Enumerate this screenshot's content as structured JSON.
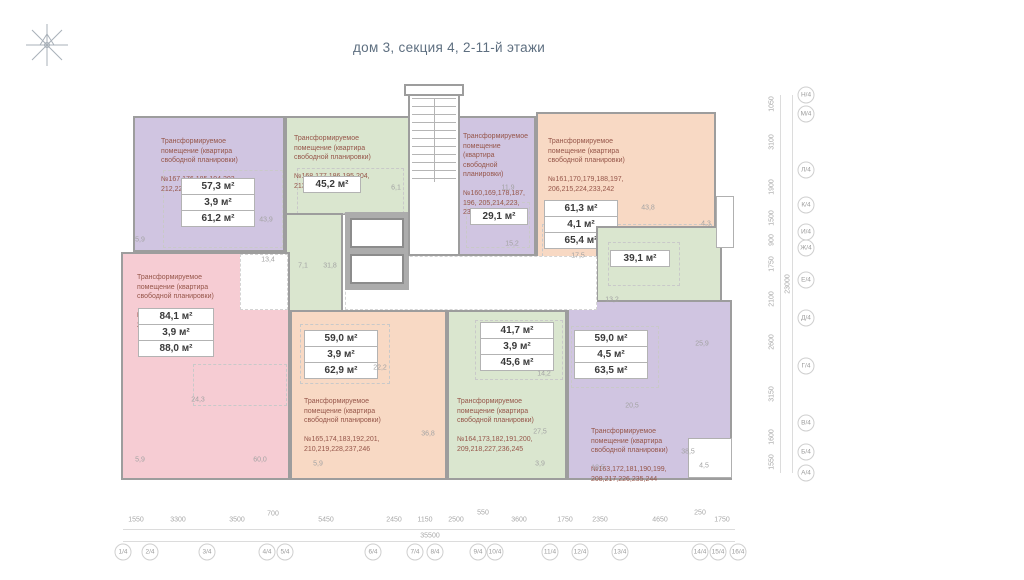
{
  "title": "дом 3, секция 4,  2-11-й этажи",
  "colors": {
    "purple": "#d0c5e1",
    "green": "#dae6cf",
    "orange": "#f8d9c4",
    "pink": "#f6ccd3",
    "wall": "#9d9d9d",
    "label_text": "#96564a",
    "dim_text": "#a3a3a3",
    "title_text": "#5e6f80"
  },
  "apartments": [
    {
      "label": "Трансформируемое\nпомещение (квартира\nсвободной планировки)",
      "numbers": "№167,176,185,194,203,\n212,221,230,239,248",
      "areas": [
        "57,3 м²",
        "3,9 м²",
        "61,2 м²"
      ]
    },
    {
      "label": "Трансформируемое\nпомещение (квартира\nсвободной планировки)",
      "numbers": "№168,177,186,195,204,\n213,222,231,240,249",
      "areas": [
        "45,2 м²"
      ]
    },
    {
      "label": "Трансформируемое\nпомещение\n(квартира\nсвободной\nпланировки)",
      "numbers": "№160,169,178,187,\n196, 205,214,223,\n232,241",
      "areas": [
        "29,1 м²"
      ]
    },
    {
      "label": "Трансформируемое\nпомещение (квартира\nсвободной планировки)",
      "numbers": "№161,170,179,188,197,\n206,215,224,233,242",
      "areas": [
        "61,3 м²",
        "4,1 м²",
        "65,4 м²"
      ]
    },
    {
      "label": "Трансформируемое\nпомещение (квартира\nсвободной планировки)",
      "numbers": "№162,171,180,189,198,\n207,216,225,234,243",
      "areas": [
        "39,1 м²"
      ]
    },
    {
      "label": "Трансформируемое\nпомещение (квартира\nсвободной планировки)",
      "numbers": "№166,175,184,193,202,\n211,220,229,238,247",
      "areas": [
        "84,1 м²",
        "3,9 м²",
        "88,0 м²"
      ]
    },
    {
      "label": "Трансформируемое\nпомещение (квартира\nсвободной планировки)",
      "numbers": "№165,174,183,192,201,\n210,219,228,237,246",
      "areas": [
        "59,0 м²",
        "3,9 м²",
        "62,9 м²"
      ]
    },
    {
      "label": "Трансформируемое\nпомещение (квартира\nсвободной планировки)",
      "numbers": "№164,173,182,191,200,\n209,218,227,236,245",
      "areas": [
        "41,7 м²",
        "3,9 м²",
        "45,6 м²"
      ]
    },
    {
      "label": "Трансформируемое\nпомещение (квартира\nсвободной планировки)",
      "numbers": "№163,172,181,190,199,\n208,217,226,235,244",
      "areas": [
        "59,0 м²",
        "4,5 м²",
        "63,5 м²"
      ]
    }
  ],
  "interior_dims": [
    {
      "t": "5,9",
      "x": 140,
      "y": 240
    },
    {
      "t": "43,9",
      "x": 266,
      "y": 220
    },
    {
      "t": "13,4",
      "x": 268,
      "y": 260
    },
    {
      "t": "7,1",
      "x": 303,
      "y": 266
    },
    {
      "t": "31,8",
      "x": 330,
      "y": 266
    },
    {
      "t": "6,1",
      "x": 396,
      "y": 188
    },
    {
      "t": "11,9",
      "x": 508,
      "y": 188
    },
    {
      "t": "15,2",
      "x": 512,
      "y": 244
    },
    {
      "t": "17,5",
      "x": 578,
      "y": 256
    },
    {
      "t": "43,8",
      "x": 648,
      "y": 208
    },
    {
      "t": "4,3",
      "x": 706,
      "y": 224
    },
    {
      "t": "13,2",
      "x": 612,
      "y": 300
    },
    {
      "t": "25,9",
      "x": 702,
      "y": 344
    },
    {
      "t": "24,3",
      "x": 198,
      "y": 400
    },
    {
      "t": "5,9",
      "x": 140,
      "y": 460
    },
    {
      "t": "60,0",
      "x": 260,
      "y": 460
    },
    {
      "t": "5,9",
      "x": 318,
      "y": 464
    },
    {
      "t": "22,2",
      "x": 380,
      "y": 368
    },
    {
      "t": "36,8",
      "x": 428,
      "y": 434
    },
    {
      "t": "14,2",
      "x": 544,
      "y": 374
    },
    {
      "t": "27,5",
      "x": 540,
      "y": 432
    },
    {
      "t": "3,9",
      "x": 540,
      "y": 464
    },
    {
      "t": "20,5",
      "x": 632,
      "y": 406
    },
    {
      "t": "38,5",
      "x": 688,
      "y": 452
    },
    {
      "t": "18,5",
      "x": 598,
      "y": 468
    },
    {
      "t": "4,5",
      "x": 704,
      "y": 466
    }
  ],
  "bottom_ruler": {
    "total": "35500",
    "segments": [
      {
        "t": "1550",
        "x": 136,
        "y": 520
      },
      {
        "t": "3300",
        "x": 178,
        "y": 520
      },
      {
        "t": "3500",
        "x": 237,
        "y": 520
      },
      {
        "t": "700",
        "x": 273,
        "y": 514
      },
      {
        "t": "5450",
        "x": 326,
        "y": 520
      },
      {
        "t": "2450",
        "x": 394,
        "y": 520
      },
      {
        "t": "1150",
        "x": 425,
        "y": 520
      },
      {
        "t": "2500",
        "x": 456,
        "y": 520
      },
      {
        "t": "550",
        "x": 483,
        "y": 513
      },
      {
        "t": "3600",
        "x": 519,
        "y": 520
      },
      {
        "t": "1750",
        "x": 565,
        "y": 520
      },
      {
        "t": "2350",
        "x": 600,
        "y": 520
      },
      {
        "t": "4650",
        "x": 660,
        "y": 520
      },
      {
        "t": "250",
        "x": 700,
        "y": 513
      },
      {
        "t": "1750",
        "x": 722,
        "y": 520
      }
    ],
    "bubbles": [
      {
        "t": "1/4",
        "x": 123,
        "y": 552
      },
      {
        "t": "2/4",
        "x": 150,
        "y": 552
      },
      {
        "t": "3/4",
        "x": 207,
        "y": 552
      },
      {
        "t": "4/4",
        "x": 267,
        "y": 552
      },
      {
        "t": "5/4",
        "x": 285,
        "y": 552
      },
      {
        "t": "6/4",
        "x": 373,
        "y": 552
      },
      {
        "t": "7/4",
        "x": 415,
        "y": 552
      },
      {
        "t": "8/4",
        "x": 435,
        "y": 552
      },
      {
        "t": "9/4",
        "x": 478,
        "y": 552
      },
      {
        "t": "10/4",
        "x": 495,
        "y": 552
      },
      {
        "t": "11/4",
        "x": 550,
        "y": 552
      },
      {
        "t": "12/4",
        "x": 580,
        "y": 552
      },
      {
        "t": "13/4",
        "x": 620,
        "y": 552
      },
      {
        "t": "14/4",
        "x": 700,
        "y": 552
      },
      {
        "t": "15/4",
        "x": 718,
        "y": 552
      },
      {
        "t": "16/4",
        "x": 738,
        "y": 552
      }
    ]
  },
  "right_ruler": {
    "total": "23000",
    "segments": [
      {
        "t": "1050",
        "x": 772,
        "y": 104
      },
      {
        "t": "3100",
        "x": 772,
        "y": 142
      },
      {
        "t": "1900",
        "x": 772,
        "y": 187
      },
      {
        "t": "1500",
        "x": 772,
        "y": 218
      },
      {
        "t": "900",
        "x": 772,
        "y": 240
      },
      {
        "t": "1750",
        "x": 772,
        "y": 264
      },
      {
        "t": "2100",
        "x": 772,
        "y": 299
      },
      {
        "t": "2600",
        "x": 772,
        "y": 342
      },
      {
        "t": "3150",
        "x": 772,
        "y": 394
      },
      {
        "t": "1600",
        "x": 772,
        "y": 437
      },
      {
        "t": "1550",
        "x": 772,
        "y": 462
      }
    ],
    "bubbles": [
      {
        "t": "Н/4",
        "x": 806,
        "y": 95
      },
      {
        "t": "М/4",
        "x": 806,
        "y": 114
      },
      {
        "t": "Л/4",
        "x": 806,
        "y": 170
      },
      {
        "t": "К/4",
        "x": 806,
        "y": 205
      },
      {
        "t": "И/4",
        "x": 806,
        "y": 232
      },
      {
        "t": "Ж/4",
        "x": 806,
        "y": 248
      },
      {
        "t": "Е/4",
        "x": 806,
        "y": 280
      },
      {
        "t": "Д/4",
        "x": 806,
        "y": 318
      },
      {
        "t": "Г/4",
        "x": 806,
        "y": 366
      },
      {
        "t": "В/4",
        "x": 806,
        "y": 423
      },
      {
        "t": "Б/4",
        "x": 806,
        "y": 452
      },
      {
        "t": "А/4",
        "x": 806,
        "y": 473
      }
    ]
  }
}
